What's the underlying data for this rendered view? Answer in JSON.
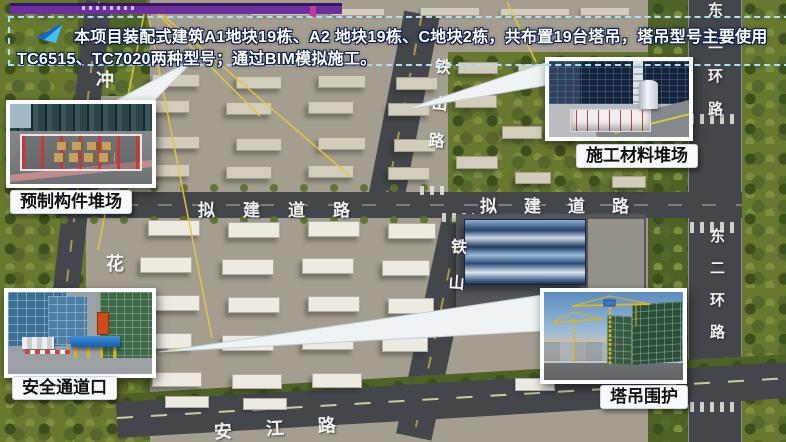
{
  "banner": {
    "line1": "本项目装配式建筑A1地块19栋、A2 地块19栋、C地块2栋，共布置19台塔吊，塔吊型号主要使用",
    "line2": "TC6515、TC7020两种型号；通过BIM模拟施工。",
    "icon": "paper-plane-arrow-icon"
  },
  "callouts": {
    "prefab": {
      "label": "预制构件堆场"
    },
    "material": {
      "label": "施工材料堆场"
    },
    "safety": {
      "label": "安全通道口"
    },
    "crane": {
      "label": "塔吊围护"
    }
  },
  "roads": {
    "tieshan": "铁山路",
    "nijian": "拟建道路",
    "donger": "东二环路",
    "hua": "花",
    "chong": "冲",
    "anjiang": "安江路"
  },
  "colors": {
    "accent_purple": "#6b2fa0",
    "banner_border": "#aee0f5",
    "arrow_blue": "#1f8fe0",
    "callout_frame": "#fcfdfe",
    "label_bg": "#f7fafc",
    "label_text": "#111111",
    "road_text": "#ffffff"
  }
}
